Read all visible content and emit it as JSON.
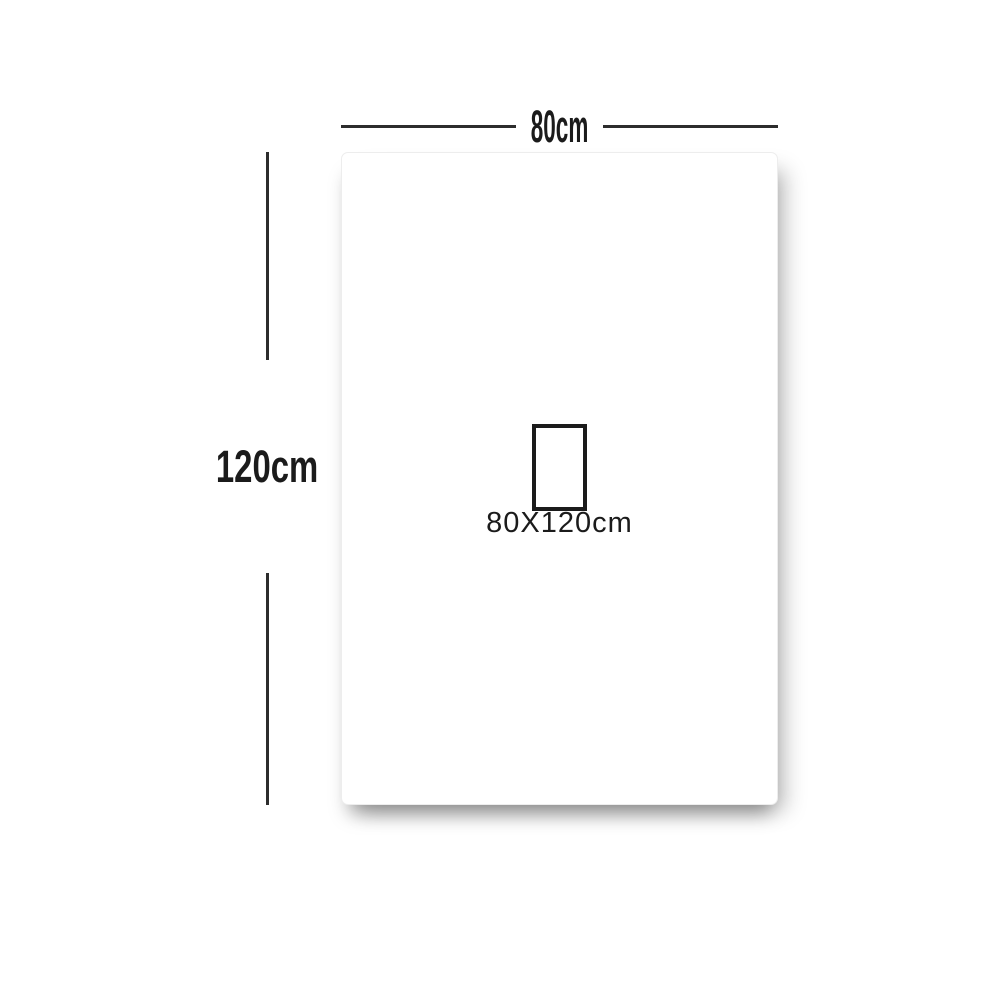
{
  "diagram": {
    "width_label": "80cm",
    "height_label": "120cm",
    "size_label": "80X120cm"
  },
  "colors": {
    "background": "#ffffff",
    "panel_fill": "#ffffff",
    "panel_edge": "#ededed",
    "dimension_line": "#2d2d2d",
    "text": "#1b1b1b"
  }
}
